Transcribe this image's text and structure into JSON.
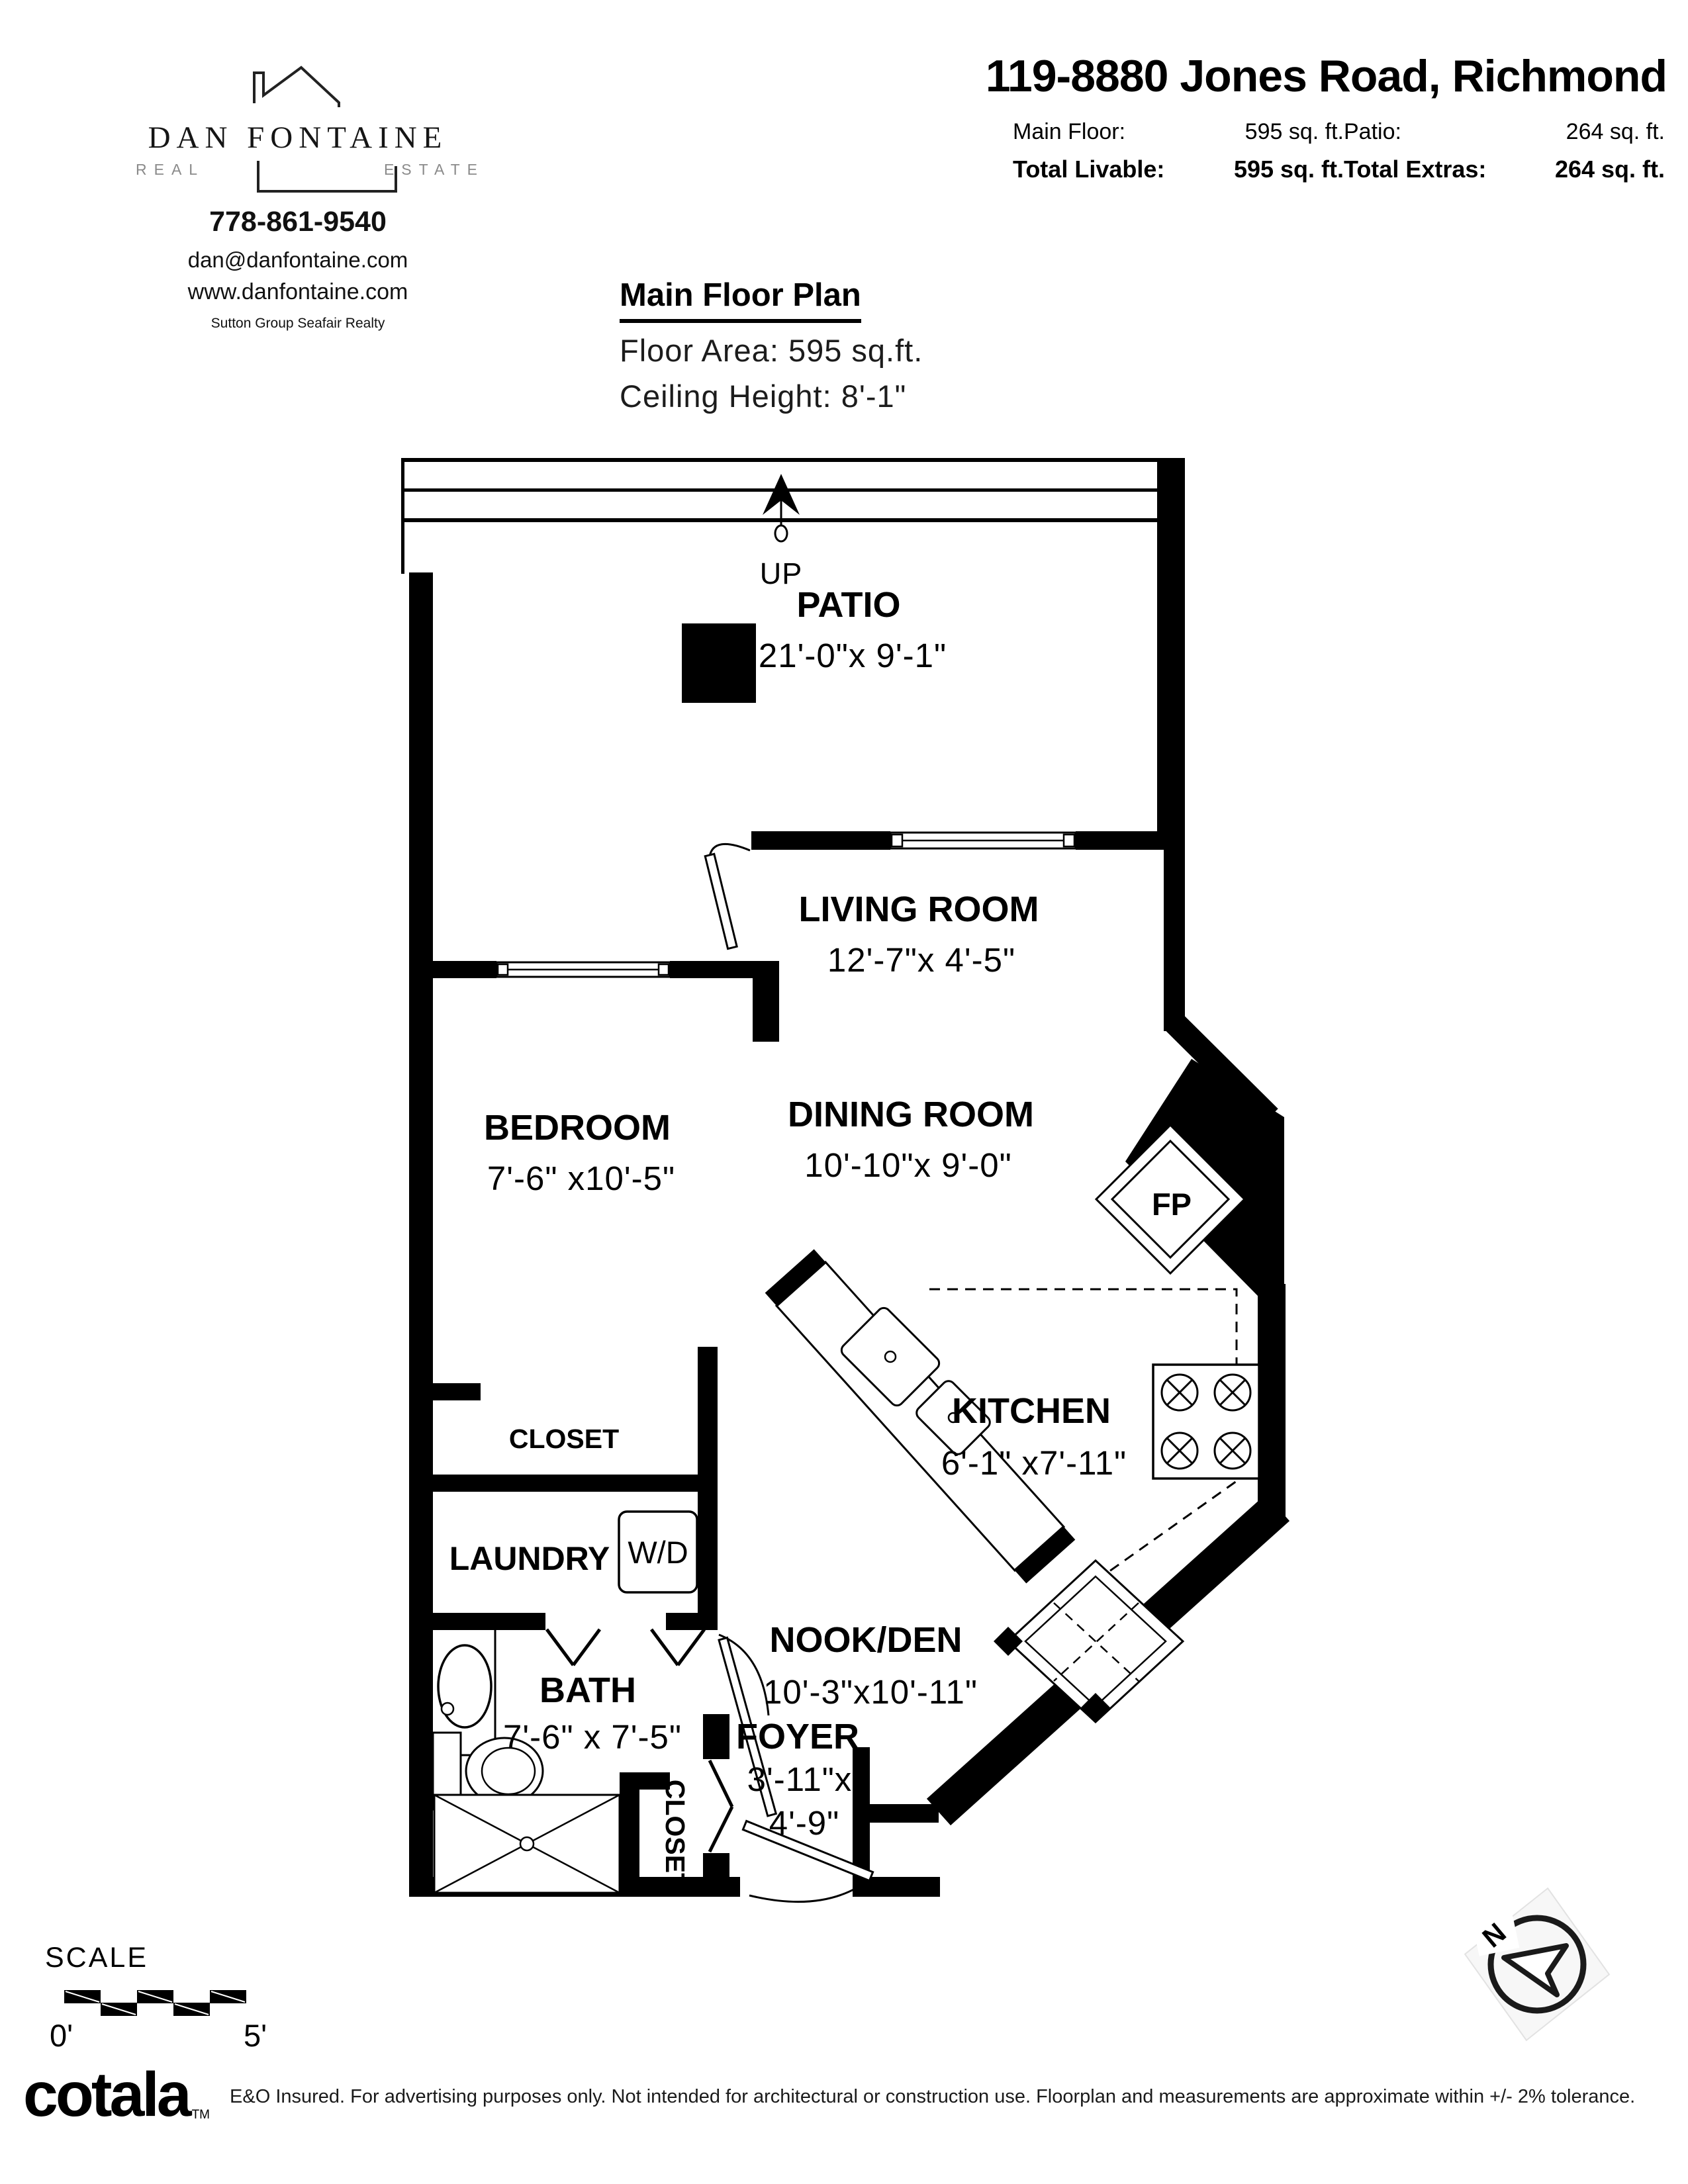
{
  "agent": {
    "name": "DAN FONTAINE",
    "tagline_left": "REAL",
    "tagline_right": "ESTATE",
    "phone": "778-861-9540",
    "email": "dan@danfontaine.com",
    "website": "www.danfontaine.com",
    "brokerage": "Sutton Group Seafair Realty"
  },
  "header": {
    "address": "119-8880 Jones Road, Richmond",
    "stats": [
      {
        "label": "Main Floor:",
        "value": "595 sq. ft."
      },
      {
        "label": "Patio:",
        "value": "264 sq. ft."
      },
      {
        "label": "Total Livable:",
        "value": "595 sq. ft."
      },
      {
        "label": "Total Extras:",
        "value": "264 sq. ft."
      }
    ]
  },
  "plan_title": {
    "title": "Main Floor Plan",
    "floor_area": "Floor Area: 595 sq.ft.",
    "ceiling": "Ceiling Height: 8'-1\""
  },
  "rooms": {
    "patio": {
      "name": "PATIO",
      "dims": "21'-0\"x 9'-1\""
    },
    "living": {
      "name": "LIVING ROOM",
      "dims": "12'-7\"x 4'-5\""
    },
    "bedroom": {
      "name": "BEDROOM",
      "dims": "7'-6\" x10'-5\""
    },
    "dining": {
      "name": "DINING ROOM",
      "dims": "10'-10\"x 9'-0\""
    },
    "kitchen": {
      "name": "KITCHEN",
      "dims": "6'-1\" x7'-11\""
    },
    "nook": {
      "name": "NOOK/DEN",
      "dims": "10'-3\"x10'-11\""
    },
    "bath": {
      "name": "BATH",
      "dims": "7'-6\" x 7'-5\""
    },
    "laundry": {
      "name": "LAUNDRY"
    },
    "foyer": {
      "name": "FOYER",
      "dims_line1": "3'-11\"x",
      "dims_line2": "4'-9\""
    }
  },
  "labels": {
    "up": "UP",
    "wd": "W/D",
    "fp": "FP",
    "closet_bedroom": "CLOSET",
    "closet_foyer": "CLOSET"
  },
  "scale": {
    "label": "SCALE",
    "start": "0'",
    "end": "5'"
  },
  "compass": {
    "north": "N"
  },
  "footer": {
    "logo": "cotala",
    "tm": "TM",
    "disclaimer": "E&O Insured. For advertising purposes only. Not intended for architectural or construction use. Floorplan and measurements are approximate within +/- 2% tolerance."
  },
  "colors": {
    "wall": "#000000",
    "background": "#ffffff",
    "muted": "#8a8a8a"
  }
}
